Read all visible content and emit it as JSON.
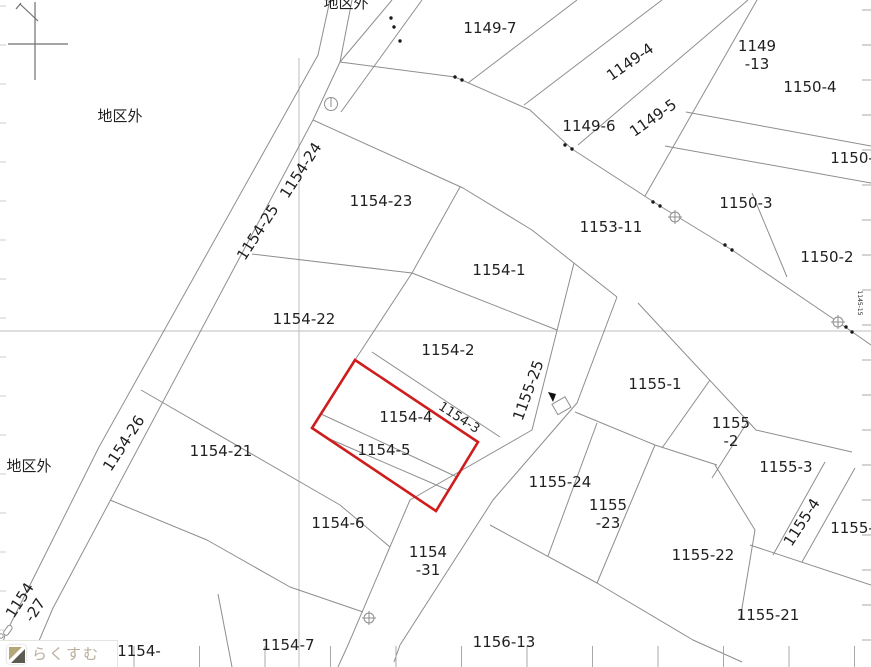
{
  "map": {
    "colors": {
      "boundary": "#8e8e8e",
      "grid": "#bcbcbc",
      "tick": "#a8a8a8",
      "label": "#1f1f1f",
      "highlight": "#cf1d1d",
      "dot": "#1a1a1a"
    },
    "labels": [
      {
        "t": "地区外",
        "x": 120,
        "y": 121,
        "r": 0
      },
      {
        "t": "地区外",
        "x": 346,
        "y": 8,
        "r": 0
      },
      {
        "t": "1149-7",
        "x": 490,
        "y": 33,
        "r": 0
      },
      {
        "t": "1149-4",
        "x": 633,
        "y": 66,
        "r": -35
      },
      {
        "t": [
          "1149",
          "-13"
        ],
        "x": 757,
        "y": 51,
        "r": 0
      },
      {
        "t": "1150-4",
        "x": 810,
        "y": 92,
        "r": 0
      },
      {
        "t": "1149-5",
        "x": 656,
        "y": 122,
        "r": -35
      },
      {
        "t": "1149-6",
        "x": 589,
        "y": 131,
        "r": 0
      },
      {
        "t": "1150-",
        "x": 852,
        "y": 163,
        "r": 0
      },
      {
        "t": "1150-3",
        "x": 746,
        "y": 208,
        "r": 0
      },
      {
        "t": "1153-11",
        "x": 611,
        "y": 232,
        "r": 0
      },
      {
        "t": "1150-2",
        "x": 827,
        "y": 262,
        "r": 0
      },
      {
        "t": "1154-23",
        "x": 381,
        "y": 206,
        "r": 0
      },
      {
        "t": "1154-24",
        "x": 305,
        "y": 173,
        "r": -57
      },
      {
        "t": "1154-25",
        "x": 262,
        "y": 235,
        "r": -57
      },
      {
        "t": "1154-1",
        "x": 499,
        "y": 275,
        "r": 0
      },
      {
        "t": "1154-22",
        "x": 304,
        "y": 324,
        "r": 0
      },
      {
        "t": "1154-2",
        "x": 448,
        "y": 355,
        "r": 0
      },
      {
        "t": "1155-1",
        "x": 655,
        "y": 389,
        "r": 0
      },
      {
        "t": "1155-25",
        "x": 533,
        "y": 392,
        "r": -70
      },
      {
        "t": "1154-4",
        "x": 406,
        "y": 422,
        "r": 0
      },
      {
        "t": "1154-3",
        "x": 457,
        "y": 421,
        "r": 33,
        "size": 13
      },
      {
        "t": "1154-21",
        "x": 221,
        "y": 456,
        "r": 0
      },
      {
        "t": "1154-26",
        "x": 128,
        "y": 446,
        "r": -57
      },
      {
        "t": "地区外",
        "x": 29,
        "y": 471,
        "r": 0
      },
      {
        "t": "1154-5",
        "x": 384,
        "y": 455,
        "r": 0
      },
      {
        "t": [
          "1155",
          "-2"
        ],
        "x": 731,
        "y": 428,
        "r": 0
      },
      {
        "t": "1155-3",
        "x": 786,
        "y": 472,
        "r": 0
      },
      {
        "t": "1155-24",
        "x": 560,
        "y": 487,
        "r": 0
      },
      {
        "t": [
          "1155",
          "-23"
        ],
        "x": 608,
        "y": 510,
        "r": 0
      },
      {
        "t": "1154-6",
        "x": 338,
        "y": 528,
        "r": 0
      },
      {
        "t": "1155-4",
        "x": 806,
        "y": 525,
        "r": -57
      },
      {
        "t": "1155-",
        "x": 852,
        "y": 533,
        "r": 0
      },
      {
        "t": "1155-22",
        "x": 703,
        "y": 560,
        "r": 0
      },
      {
        "t": [
          "1154",
          "-31"
        ],
        "x": 428,
        "y": 557,
        "r": 0
      },
      {
        "t": [
          "1154",
          "-27"
        ],
        "x": 24,
        "y": 603,
        "r": -57
      },
      {
        "t": "1155-21",
        "x": 768,
        "y": 620,
        "r": 0
      },
      {
        "t": "1156-13",
        "x": 504,
        "y": 647,
        "r": 0
      },
      {
        "t": "1154-7",
        "x": 288,
        "y": 650,
        "r": 0
      },
      {
        "t": "1154-",
        "x": 139,
        "y": 656,
        "r": 0
      },
      {
        "t": "1145-15",
        "x": 858,
        "y": 303,
        "r": 90,
        "size": 6
      }
    ],
    "boundary_dots": [
      [
        391,
        18
      ],
      [
        394,
        27
      ],
      [
        400,
        41
      ],
      [
        455,
        77
      ],
      [
        462,
        80
      ],
      [
        565,
        145
      ],
      [
        572,
        149
      ],
      [
        653,
        202
      ],
      [
        660,
        206
      ],
      [
        725,
        245
      ],
      [
        732,
        250
      ],
      [
        846,
        327
      ],
      [
        852,
        332
      ]
    ],
    "benchmarks": [
      [
        675,
        217
      ],
      [
        838,
        322
      ],
      [
        369,
        618
      ]
    ],
    "border_ticks": {
      "right": {
        "x": 871,
        "len": 9,
        "y_start": 10,
        "step": 35,
        "count": 19
      },
      "left": {
        "x": 0,
        "len": 6,
        "y_start": 6,
        "step": 39,
        "count": 17
      },
      "bottom": {
        "y": 646,
        "len": 21,
        "x_start": 3,
        "step": 65.5,
        "count": 14
      }
    },
    "watermark": {
      "text": "らくすむ",
      "icon": "house-logo-icon"
    }
  }
}
